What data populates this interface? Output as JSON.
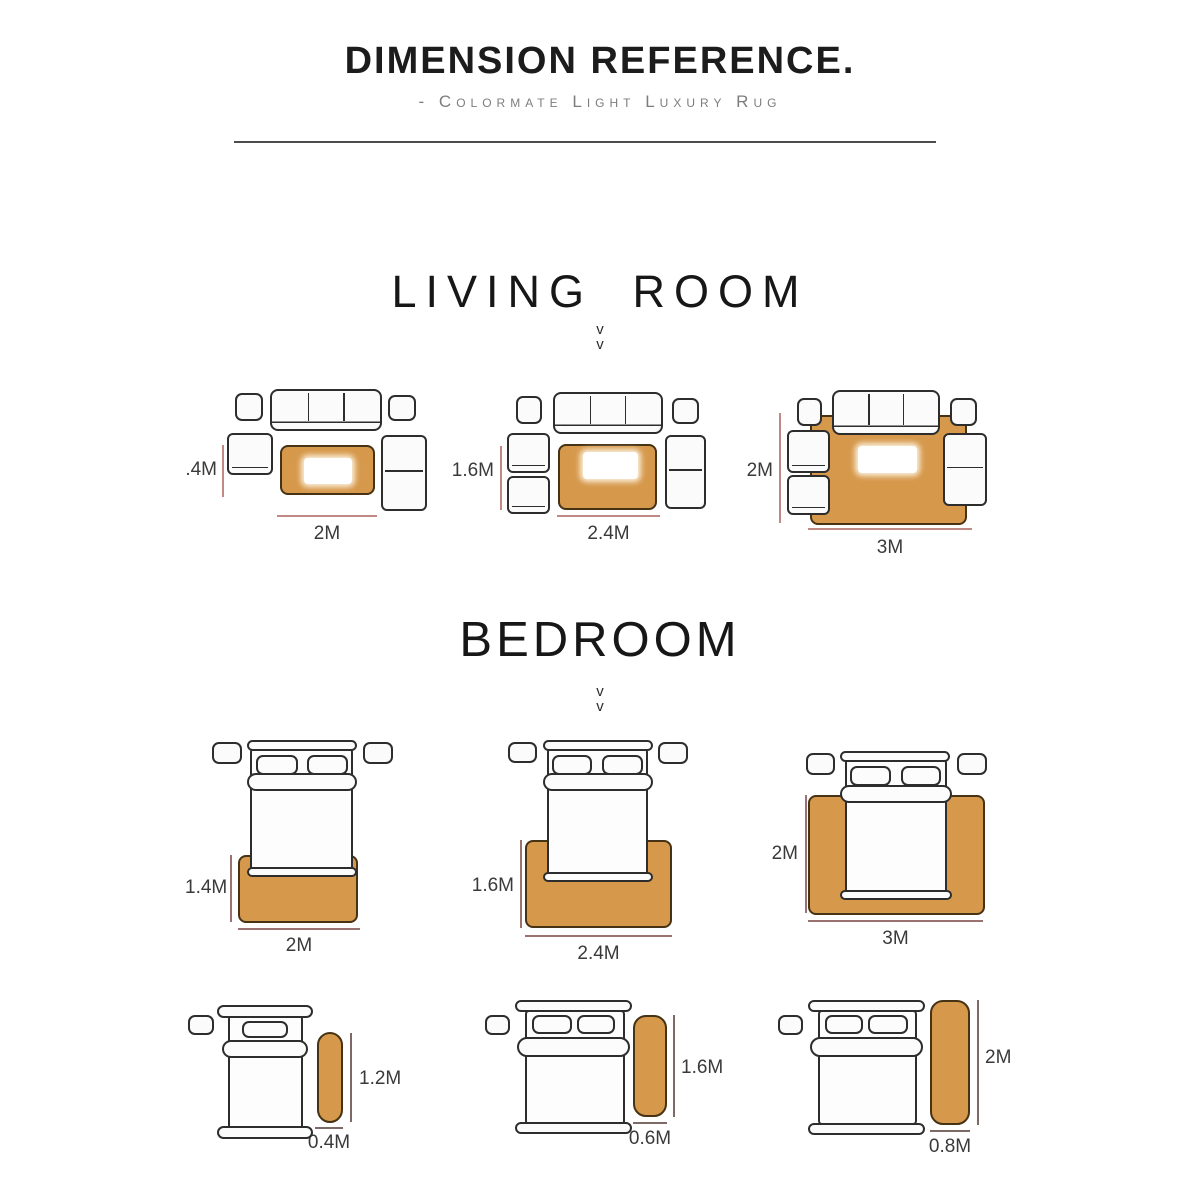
{
  "header": {
    "title": "DIMENSION REFERENCE.",
    "subtitle": "- Colormate Light Luxury Rug"
  },
  "sections": {
    "living_room": {
      "label": "LIVING  ROOM"
    },
    "bedroom": {
      "label": "BEDROOM"
    },
    "chevron_glyph": "v"
  },
  "colors": {
    "rug_fill": "#d6984b",
    "rug_border": "#463215",
    "dim_living": "#c18983",
    "dim_bedroom": "#9a7370",
    "dim_runner": "#7d6a67"
  },
  "living_room_layouts": [
    {
      "height_label": ".4M",
      "width_label": "2M"
    },
    {
      "height_label": "1.6M",
      "width_label": "2.4M"
    },
    {
      "height_label": "2M",
      "width_label": "3M"
    }
  ],
  "bedroom_layouts": [
    {
      "height_label": "1.4M",
      "width_label": "2M"
    },
    {
      "height_label": "1.6M",
      "width_label": "2.4M"
    },
    {
      "height_label": "2M",
      "width_label": "3M"
    }
  ],
  "runner_layouts": [
    {
      "height_label": "1.2M",
      "width_label": "0.4M"
    },
    {
      "height_label": "1.6M",
      "width_label": "0.6M"
    },
    {
      "height_label": "2M",
      "width_label": "0.8M"
    }
  ]
}
